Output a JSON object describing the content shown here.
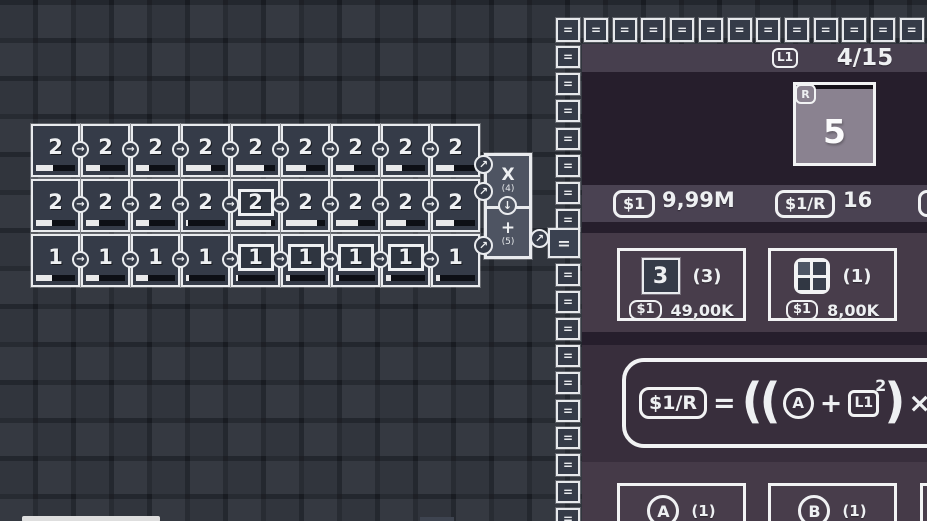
{
  "colors": {
    "background": "#252932",
    "tile_fill": "#353b48",
    "tile_border": "#e9ebee",
    "combiner_fill": "#4e5462",
    "panel_body": "#261e2c",
    "panel_header": "#473f4e",
    "stats_bar": "#4a4252",
    "shop_band": "#453a48",
    "formula_band": "#382e3c",
    "bottom_band": "#453a48",
    "generator_fill": "#8a8290",
    "progress_fill": "#e9e9ea",
    "progress_track": "#0d0f15"
  },
  "icons": {
    "conveyor_right": "→",
    "merge_up_right": "↗",
    "down_arrow": "↓",
    "border_equals": "="
  },
  "grid": {
    "rows": [
      {
        "tiles": [
          {
            "value": "2",
            "boxed": false,
            "progress": 44
          },
          {
            "value": "2",
            "boxed": false,
            "progress": 35
          },
          {
            "value": "2",
            "boxed": false,
            "progress": 34
          },
          {
            "value": "2",
            "boxed": false,
            "progress": 64
          },
          {
            "value": "2",
            "boxed": false,
            "progress": 72
          },
          {
            "value": "2",
            "boxed": false,
            "progress": 52
          },
          {
            "value": "2",
            "boxed": false,
            "progress": 46
          },
          {
            "value": "2",
            "boxed": false,
            "progress": 42
          },
          {
            "value": "2",
            "boxed": false,
            "progress": 46
          }
        ]
      },
      {
        "tiles": [
          {
            "value": "2",
            "boxed": false,
            "progress": 40
          },
          {
            "value": "2",
            "boxed": false,
            "progress": 33
          },
          {
            "value": "2",
            "boxed": false,
            "progress": 34
          },
          {
            "value": "2",
            "boxed": false,
            "progress": 5
          },
          {
            "value": "2",
            "boxed": true,
            "progress": 90
          },
          {
            "value": "2",
            "boxed": false,
            "progress": 80
          },
          {
            "value": "2",
            "boxed": false,
            "progress": 56
          },
          {
            "value": "2",
            "boxed": false,
            "progress": 50
          },
          {
            "value": "2",
            "boxed": false,
            "progress": 46
          }
        ]
      },
      {
        "tiles": [
          {
            "value": "1",
            "boxed": false,
            "progress": 40
          },
          {
            "value": "1",
            "boxed": false,
            "progress": 34
          },
          {
            "value": "1",
            "boxed": false,
            "progress": 30
          },
          {
            "value": "1",
            "boxed": false,
            "progress": 8
          },
          {
            "value": "1",
            "boxed": true,
            "progress": 6
          },
          {
            "value": "1",
            "boxed": true,
            "progress": 10
          },
          {
            "value": "1",
            "boxed": true,
            "progress": 7
          },
          {
            "value": "1",
            "boxed": true,
            "progress": 12
          },
          {
            "value": "1",
            "boxed": false,
            "progress": 10
          }
        ]
      }
    ]
  },
  "combiner": {
    "multiply": {
      "label": "X",
      "count": "(4)"
    },
    "add": {
      "label": "+",
      "count": "(5)"
    }
  },
  "panel": {
    "header": {
      "level_badge": "L1",
      "progress": "4/15"
    },
    "generator": {
      "badge": "R",
      "value": "5"
    },
    "stats": [
      {
        "badge": "$1",
        "value": "9,99M"
      },
      {
        "badge": "$1/R",
        "value": "16"
      }
    ],
    "shop_items": [
      {
        "icon": "number-tile",
        "tile_value": "3",
        "count": "(3)",
        "price_badge": "$1",
        "price": "49,00K"
      },
      {
        "icon": "grid-2x2",
        "count": "(1)",
        "price_badge": "$1",
        "price": "8,00K"
      }
    ],
    "formula": {
      "tokens": [
        {
          "type": "badge",
          "text": "$1/R"
        },
        {
          "type": "op",
          "text": "="
        },
        {
          "type": "paren",
          "text": "(("
        },
        {
          "type": "circle",
          "text": "A"
        },
        {
          "type": "op",
          "text": "+"
        },
        {
          "type": "sq",
          "text": "L1",
          "sup": "2"
        },
        {
          "type": "paren",
          "text": ")"
        },
        {
          "type": "op",
          "text": "×"
        },
        {
          "type": "circle",
          "text": "B"
        },
        {
          "type": "paren",
          "text": ")"
        }
      ]
    },
    "owned_items": [
      {
        "letter": "A",
        "count": "(1)"
      },
      {
        "letter": "B",
        "count": "(1)"
      }
    ]
  }
}
